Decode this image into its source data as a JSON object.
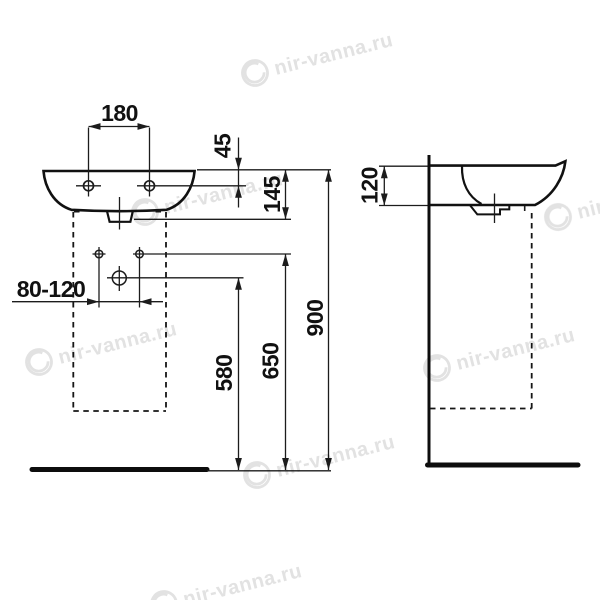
{
  "drawing": {
    "subject": "wall-hung washbasin installation drawing, front and side views",
    "background": "#ffffff",
    "line_color": "#111111"
  },
  "labels": {
    "tap_hole_spacing": "180",
    "rim_to_tap_hole": "45",
    "rim_to_outlet": "145",
    "fixing_range": "80-120",
    "trap_height": "580",
    "connection_height": "650",
    "rim_height": "900",
    "basin_depth": "120"
  },
  "watermark": {
    "text": "nir-vanna.ru",
    "color": "#e2e2e2"
  }
}
